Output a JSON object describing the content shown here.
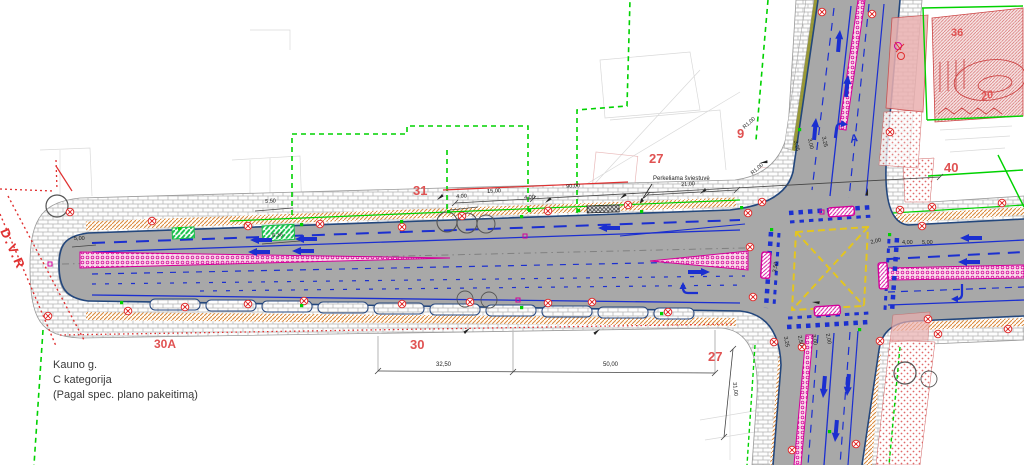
{
  "drawing": {
    "street_block": {
      "name": "Kauno g.",
      "category": "C kategorija",
      "note": "(Pagal spec. plano pakeitimą)"
    },
    "boundary_marker": "D.V.R",
    "section_marker": "A",
    "annotation_light": "Perkeliama šviestuvė",
    "parcel_numbers": {
      "p31": "31",
      "p27_top": "27",
      "p9": "9",
      "p40": "40",
      "p36": "36",
      "p20": "20",
      "p30a": "30A",
      "p30": "30",
      "p27_bottom": "27"
    },
    "dimensions": {
      "d15_00": "15,00",
      "d90_00": "90,00",
      "d21_00": "21,00",
      "d4_00": "4,00",
      "d5_50": "5,50",
      "d6_36": "6,36",
      "d5_00": "5,00",
      "d32_50": "32,50",
      "d50_00": "50,00",
      "d31_00": "31,00",
      "r1_00": "R1,00",
      "d2_00": "2,00",
      "d3_50": "3,50",
      "d3_25": "3,25",
      "d3_00": "3,00",
      "d2_50": "2,50"
    },
    "colors": {
      "road_gray": "#a8a8a8",
      "curb_navy": "#23477d",
      "lane_blue": "#1b2fd0",
      "boundary_green": "#00d200",
      "parcel_red": "#e05252",
      "magenta": "#d4009a",
      "hatch_orange": "#d9873a",
      "box_yellow": "#e3c520",
      "stipple_red": "#e06a6a",
      "olive": "#8f8f22"
    }
  }
}
